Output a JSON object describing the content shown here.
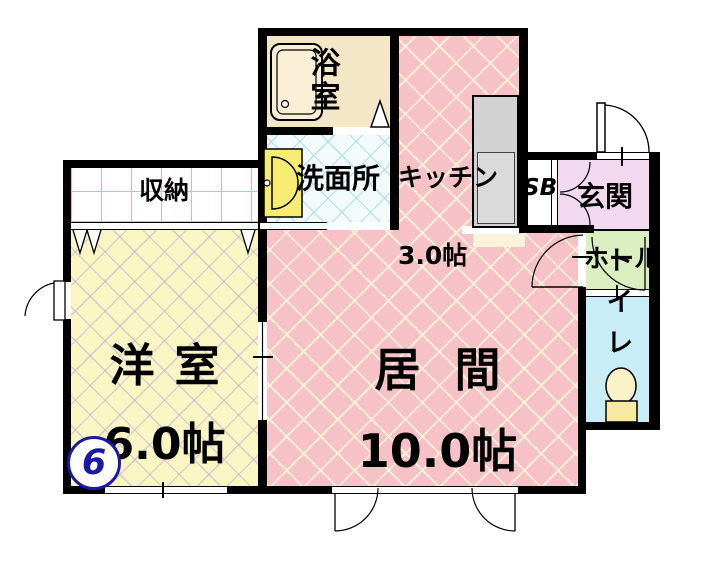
{
  "floorplan": {
    "unit_number": "6",
    "rooms": {
      "bath": {
        "label": "浴室"
      },
      "washroom": {
        "label": "洗面所"
      },
      "kitchen": {
        "label": "キッチン",
        "size": "3.0帖"
      },
      "shoebox": {
        "label": "SB"
      },
      "entrance": {
        "label": "玄関"
      },
      "hall": {
        "label": "ホール"
      },
      "toilet": {
        "label": "トイレ"
      },
      "closet": {
        "label": "収納"
      },
      "western_room": {
        "label": "洋室",
        "size": "6.0帖"
      },
      "living_room": {
        "label": "居間",
        "size": "10.0帖"
      }
    },
    "colors": {
      "living_kitchen_floor": "#f6c1c7",
      "western_room_floor": "#faf6c3",
      "washroom_floor": "#f3fbfa",
      "bath_floor": "#f3e7c6",
      "entrance_floor": "#f2d9f0",
      "hall_floor": "#daeec0",
      "toilet_floor": "#c8edf7",
      "closet_floor": "#ffffff",
      "counter": "#d2d2d2",
      "sink": "#f6ec72",
      "toilet_fixture": "#fbf3c8",
      "unit_badge": "#1a18a8",
      "walls": "#000000"
    }
  }
}
